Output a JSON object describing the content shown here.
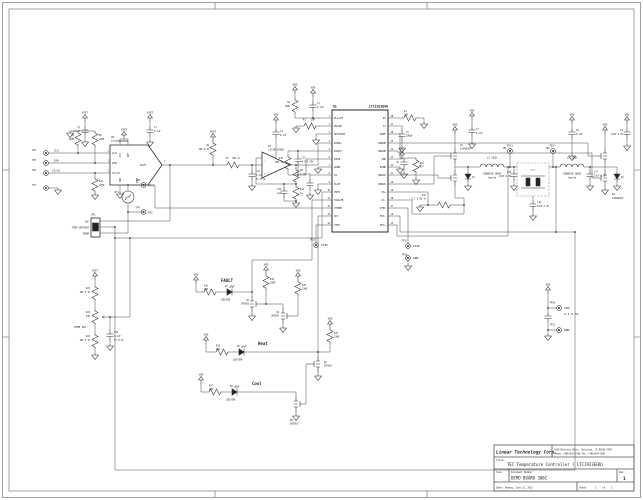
{
  "power": {
    "vdd": "VDD",
    "vset": "VSET"
  },
  "inputs": {
    "tp4": "TP4",
    "tp5": "TP5",
    "tp6": "TP6",
    "tp7": "TP7",
    "sig_clk": "CLK",
    "sig_din": "DIN",
    "sig_csld": "CS/LD",
    "r5": {
      "ref": "R5",
      "val": "100K"
    },
    "r6": {
      "ref": "R6",
      "val": "100K"
    },
    "r12": {
      "ref": "R12",
      "val": "100K"
    },
    "c2": {
      "ref": "C2",
      "val": "0.1uF"
    },
    "c3": {
      "ref": "C3",
      "val": "0.1uF"
    }
  },
  "dac": {
    "ref": "U2",
    "part": "LTC1658CMS8",
    "n1": "1",
    "n2": "2",
    "n3": "3",
    "n7": "7",
    "pin_clk": "CLK",
    "pin_din": "DIN",
    "pin_csld": "CS/LD",
    "pin_vout": "VOUT",
    "pin_vcc": "VCC",
    "pin_ref": "REF",
    "pin_gnd": "GND",
    "pin_dout": "DOUT"
  },
  "setpoint": {
    "r9": {
      "ref": "R9",
      "val": "10K 0.1%"
    },
    "r7": {
      "ref": "R7",
      "val": "10K 1%"
    },
    "c11": {
      "ref": "C11",
      "val": "0.1uF",
      "note": "5% Film"
    },
    "u3": {
      "ref": "U3",
      "part": "LTC2053CMS8",
      "plus": "+",
      "minus": "-"
    },
    "c4": {
      "ref": "C4",
      "val": "0.1uF"
    },
    "r8": {
      "ref": "R8",
      "val": "9.09K 1%"
    },
    "r14": {
      "ref": "R14",
      "val": "1%"
    },
    "c19": {
      "ref": "C19",
      "val": "1uF"
    }
  },
  "thermistor": {
    "rt1": "RT1",
    "tp8": "TP8",
    "ntc_p": "NTC+",
    "tp9": "TP9",
    "ntc_m": "NTC-"
  },
  "jumper": {
    "ref": "JP1",
    "o1": "DAC",
    "o2": "TEMP SETPOINT",
    "o3": "THERM"
  },
  "temp_adj": {
    "r21": {
      "ref": "R21",
      "val": "10K 0.1%"
    },
    "r22": {
      "ref": "R22",
      "val": "20K"
    },
    "label": "TEMP ADJ.",
    "r24": {
      "ref": "R24",
      "val": "10K 0.1%"
    },
    "c23": {
      "ref": "C23",
      "val": "0.1uF",
      "note": "5% Film"
    }
  },
  "u1": {
    "ref": "U1",
    "part": "LTC1923EGN",
    "left": [
      {
        "n": "1",
        "name": "PLLLPF"
      },
      {
        "n": "2",
        "name": "RSLEW"
      },
      {
        "n": "3",
        "name": "SDSYNCB"
      },
      {
        "n": "4",
        "name": "EAIN+"
      },
      {
        "n": "5",
        "name": "EAOUT"
      },
      {
        "n": "6",
        "name": "EAIN-"
      },
      {
        "n": "7",
        "name": "AGND"
      },
      {
        "n": "8",
        "name": "SS"
      },
      {
        "n": "9",
        "name": "ILIM"
      },
      {
        "n": "10",
        "name": "VSET"
      },
      {
        "n": "11",
        "name": "FAULTB"
      },
      {
        "n": "12",
        "name": "VTHRM"
      },
      {
        "n": "13",
        "name": "H/C"
      },
      {
        "n": "14",
        "name": "VTEC"
      }
    ],
    "right": [
      {
        "n": "28",
        "name": "RT"
      },
      {
        "n": "27",
        "name": "CT"
      },
      {
        "n": "26",
        "name": "VREF"
      },
      {
        "n": "25",
        "name": "PDRVB"
      },
      {
        "n": "24",
        "name": "NDRVB"
      },
      {
        "n": "23",
        "name": "VDD"
      },
      {
        "n": "22",
        "name": "PGND"
      },
      {
        "n": "21",
        "name": "NDRVA"
      },
      {
        "n": "20",
        "name": "PDRVA"
      },
      {
        "n": "19",
        "name": "CS+"
      },
      {
        "n": "18",
        "name": "CS-"
      },
      {
        "n": "17",
        "name": "ITEC"
      },
      {
        "n": "16",
        "name": "TEC-"
      },
      {
        "n": "15",
        "name": "TEC+"
      }
    ]
  },
  "u1_support": {
    "r4": {
      "ref": "R4",
      "val": "100K"
    },
    "c1": {
      "ref": "C1",
      "val": "0.1uF"
    },
    "r3": {
      "ref": "R3",
      "val": "10K"
    },
    "r10": {
      "ref": "R10",
      "val": "10M 1%"
    },
    "c13": {
      "ref": "C13",
      "val": "4.7uF 25V"
    },
    "r1": {
      "ref": "R1",
      "val": "10K"
    },
    "c5": {
      "ref": "C5",
      "val": "100pF"
    },
    "c6": {
      "ref": "C6"
    },
    "rv1": {
      "ref": "RV1"
    }
  },
  "output_stage": {
    "q1": {
      "ref": "Q1",
      "part": "Si9801DY"
    },
    "q2": {
      "ref": "Q2",
      "part": "Si9801DY"
    },
    "c7": {
      "ref": "C7",
      "val": "0.1uF"
    },
    "c8": {
      "ref": "C8",
      "val": "0.1uF"
    },
    "c9": {
      "ref": "C9",
      "val": "10uF 6.3V"
    },
    "d1": "D1",
    "d2": "D2",
    "l1": {
      "rv": "L1 10uH",
      "part": "CDRH6D28-100NC",
      "mfr": "Sumida"
    },
    "l2": {
      "rv": "L2 10uH",
      "part": "CDRH6D28-100NC",
      "mfr": "Sumida"
    },
    "c15": {
      "ref": "C15",
      "val": "22uF 6.3V"
    },
    "c16": {
      "ref": "C16",
      "val": "22uF 6.3V"
    },
    "c17": {
      "ref": "C17",
      "val": "22uF 6.3V"
    },
    "r13": {
      "ref": "R13",
      "val": "0.1 0.5W 1%"
    },
    "tec": "TEC",
    "tp1": {
      "ref": "TP1",
      "label": "TEC+"
    },
    "tp2": {
      "ref": "TP2",
      "label": "TEC-"
    }
  },
  "indicators": {
    "fault": {
      "title": "FAULT",
      "r16": {
        "ref": "R16",
        "val": "200"
      },
      "d5": {
        "ref": "D5",
        "part": "LED/RED"
      },
      "q5": {
        "ref": "Q5",
        "part": "2N7002"
      },
      "r19": {
        "ref": "R19",
        "val": "100K"
      },
      "q4": {
        "ref": "Q4",
        "part": "2N7002"
      },
      "r20": {
        "ref": "R20",
        "val": "100K"
      }
    },
    "heat": {
      "title": "Heat",
      "r25": {
        "ref": "R25",
        "val": "200"
      },
      "d6": {
        "ref": "D6",
        "part": "LED/GRN"
      },
      "r23": {
        "ref": "R23",
        "val": "100K"
      },
      "q6": {
        "ref": "Q6",
        "part": "2N7002"
      }
    },
    "cool": {
      "title": "Cool",
      "r27": {
        "ref": "R27",
        "val": "200"
      },
      "d8": {
        "ref": "D8",
        "part": "LED/GRN"
      },
      "q8": {
        "ref": "Q8",
        "part": "2N7002"
      }
    }
  },
  "test_points": {
    "tp13": {
      "ref": "TP13",
      "label": "VTEC"
    },
    "tp11": {
      "ref": "TP11",
      "label": "ITEC"
    },
    "tp14": {
      "ref": "TP14",
      "label": "GND"
    },
    "tp10": {
      "ref": "TP10",
      "label": "VDD",
      "note": "3.1-5.5V"
    },
    "tp12": {
      "ref": "TP12",
      "label": "GND"
    }
  },
  "title_block": {
    "company": "Linear Technology Corp.",
    "address1": "1630 McCarthy Blvd., Milpitas, CA 95035-7487",
    "address2": "Phone: (408)432-1900 Fax: (408)434-0507",
    "title_label": "Title:",
    "title": "TEC Temperature Controller ( LTC1923EGN)",
    "size_label": "Size",
    "doc_label": "Document Number:",
    "doc_number": "DEMO BOARD 388C",
    "rev_label": "Rev:",
    "rev": "1",
    "date_label": "Date:",
    "date": "Monday, June 23, 2013",
    "sheet_label": "Sheet",
    "sheet_num": "1",
    "of_label": "of",
    "sheet_total": "1"
  }
}
